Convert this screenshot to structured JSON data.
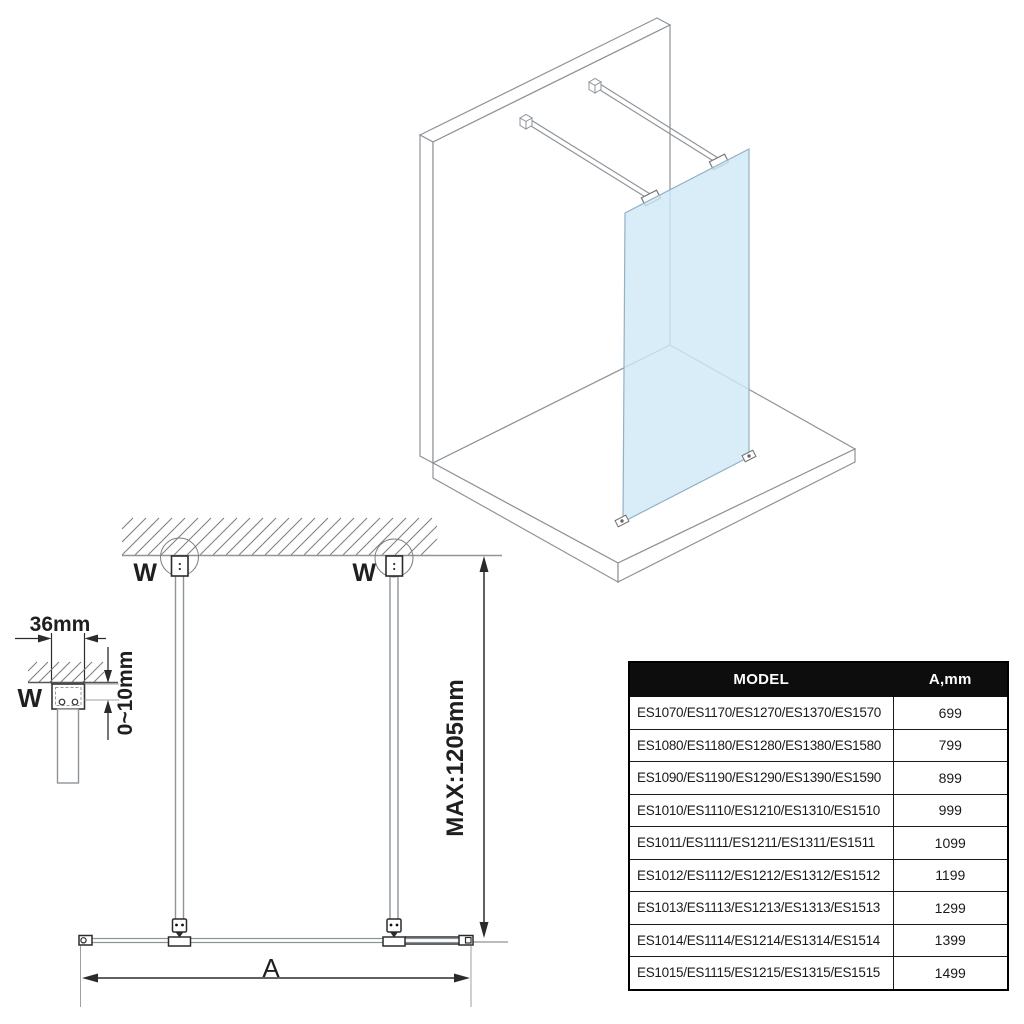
{
  "front_view": {
    "wall_label_left": "W",
    "wall_label_right": "W",
    "max_height_label": "MAX:1205mm",
    "width_label": "A"
  },
  "detail_view": {
    "wall_label": "W",
    "profile_width_label": "36mm",
    "gap_label": "0~10mm"
  },
  "table": {
    "header": {
      "model": "MODEL",
      "a": "A,mm"
    },
    "rows": [
      {
        "model": "ES1070/ES1170/ES1270/ES1370/ES1570",
        "a": "699"
      },
      {
        "model": "ES1080/ES1180/ES1280/ES1380/ES1580",
        "a": "799"
      },
      {
        "model": "ES1090/ES1190/ES1290/ES1390/ES1590",
        "a": "899"
      },
      {
        "model": "ES1010/ES1110/ES1210/ES1310/ES1510",
        "a": "999"
      },
      {
        "model": "ES1011/ES1111/ES1211/ES1311/ES1511",
        "a": "1099"
      },
      {
        "model": "ES1012/ES1112/ES1212/ES1312/ES1512",
        "a": "1199"
      },
      {
        "model": "ES1013/ES1113/ES1213/ES1313/ES1513",
        "a": "1299"
      },
      {
        "model": "ES1014/ES1114/ES1214/ES1314/ES1514",
        "a": "1399"
      },
      {
        "model": "ES1015/ES1115/ES1215/ES1315/ES1515",
        "a": "1499"
      }
    ]
  },
  "colors": {
    "glass": "#cfe9f8",
    "line_gray": "#8f9499",
    "line_dark": "#2b2b2b",
    "table_header_bg": "#0d0d0d",
    "table_header_text": "#ffffff"
  }
}
